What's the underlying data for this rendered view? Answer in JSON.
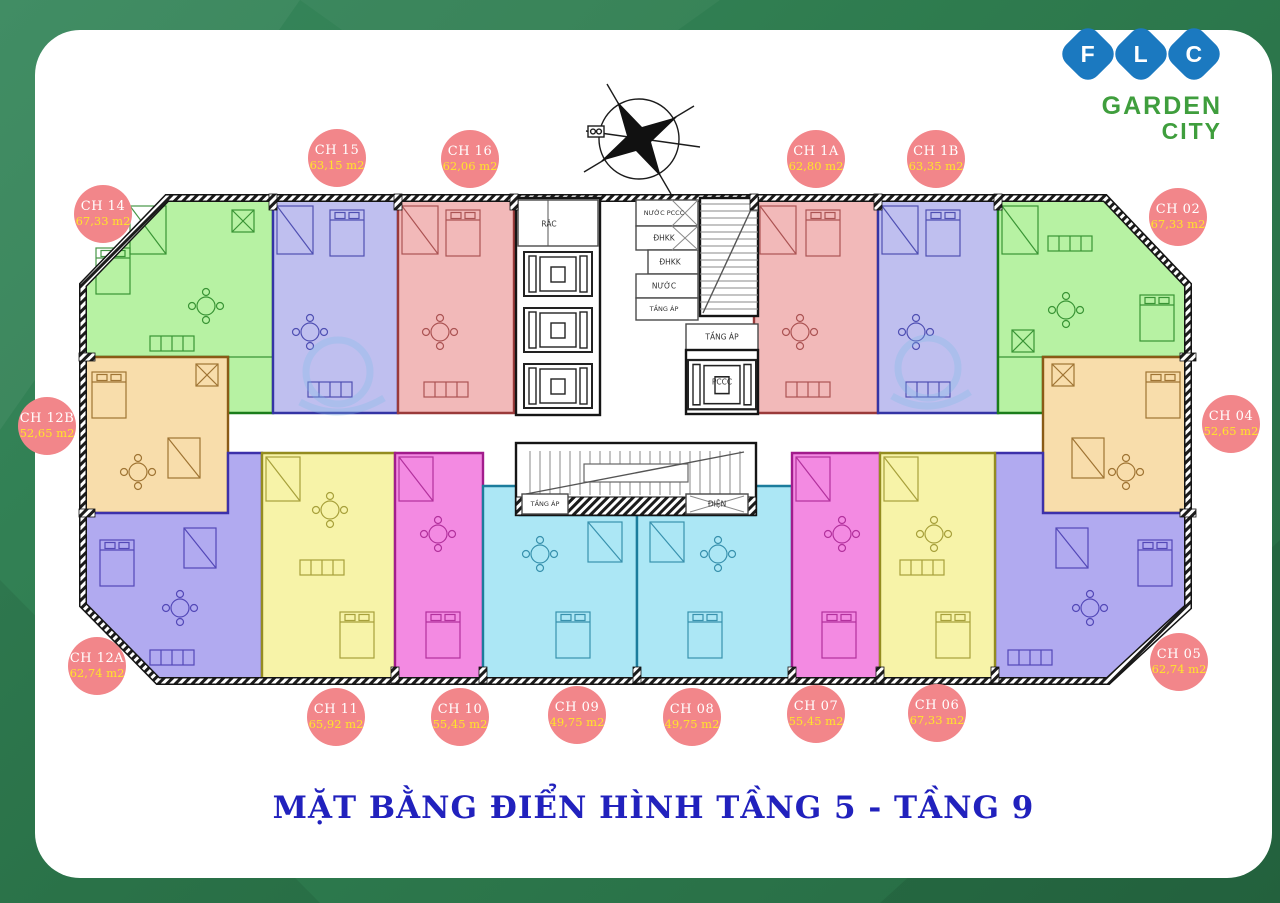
{
  "title": "MẶT BẰNG ĐIỂN HÌNH TẦNG 5 - TẦNG 9",
  "logo": {
    "letters": [
      "F",
      "L",
      "C"
    ],
    "name_line1": "GARDEN",
    "name_line2": "CITY"
  },
  "core": {
    "rac": "RÁC",
    "nuoc_pccc": "NƯỚC PCCC",
    "dhkk_a": "ĐHKK",
    "dhkk_b": "ĐHKK",
    "nuoc": "NƯỚC",
    "tang_ap_a": "TẦNG ÁP",
    "tang_ap_b": "TẦNG ÁP",
    "pccc": "PCCC",
    "tang_ap_c": "TẦNG ÁP",
    "dien": "ĐIỆN"
  },
  "units": [
    {
      "id": "CH 14",
      "area": "67,33 m2",
      "fill": "#b7f2a3",
      "stroke": "#1a7d1a"
    },
    {
      "id": "CH 15",
      "area": "63,15 m2",
      "fill": "#bfbfef",
      "stroke": "#3434a4"
    },
    {
      "id": "CH 16",
      "area": "62,06 m2",
      "fill": "#f2b9b9",
      "stroke": "#9a3a3a"
    },
    {
      "id": "CH 1A",
      "area": "62,80 m2",
      "fill": "#f2b9b9",
      "stroke": "#9a3a3a"
    },
    {
      "id": "CH 1B",
      "area": "63,35 m2",
      "fill": "#bfbfef",
      "stroke": "#3434a4"
    },
    {
      "id": "CH 02",
      "area": "67,33 m2",
      "fill": "#b7f2a3",
      "stroke": "#1a7d1a"
    },
    {
      "id": "CH 12B",
      "area": "52,65 m2",
      "fill": "#f8ddab",
      "stroke": "#8a5a16"
    },
    {
      "id": "CH 04",
      "area": "52,65 m2",
      "fill": "#f8ddab",
      "stroke": "#8a5a16"
    },
    {
      "id": "CH 12A",
      "area": "62,74 m2",
      "fill": "#b1aaf0",
      "stroke": "#3c30aa"
    },
    {
      "id": "CH 05",
      "area": "62,74 m2",
      "fill": "#b1aaf0",
      "stroke": "#3c30aa"
    },
    {
      "id": "CH 11",
      "area": "65,92 m2",
      "fill": "#f7f3a8",
      "stroke": "#948c20"
    },
    {
      "id": "CH 10",
      "area": "55,45 m2",
      "fill": "#f38ae2",
      "stroke": "#a21c8c"
    },
    {
      "id": "CH 09",
      "area": "49,75 m2",
      "fill": "#ace7f5",
      "stroke": "#1c7c9c"
    },
    {
      "id": "CH 08",
      "area": "49,75 m2",
      "fill": "#ace7f5",
      "stroke": "#1c7c9c"
    },
    {
      "id": "CH 07",
      "area": "55,45 m2",
      "fill": "#f38ae2",
      "stroke": "#a21c8c"
    },
    {
      "id": "CH 06",
      "area": "67,33 m2",
      "fill": "#f7f3a8",
      "stroke": "#948c20"
    }
  ],
  "palette": {
    "background": "#2e7b4e",
    "card": "#ffffff",
    "badge": "#f2868a",
    "badge_id_text": "#ffffff",
    "badge_area_text": "#ffe42a",
    "title_text": "#2121bd",
    "logo_blue": "#1b79c0",
    "logo_green": "#3f9e3d",
    "wall": "#141414"
  }
}
